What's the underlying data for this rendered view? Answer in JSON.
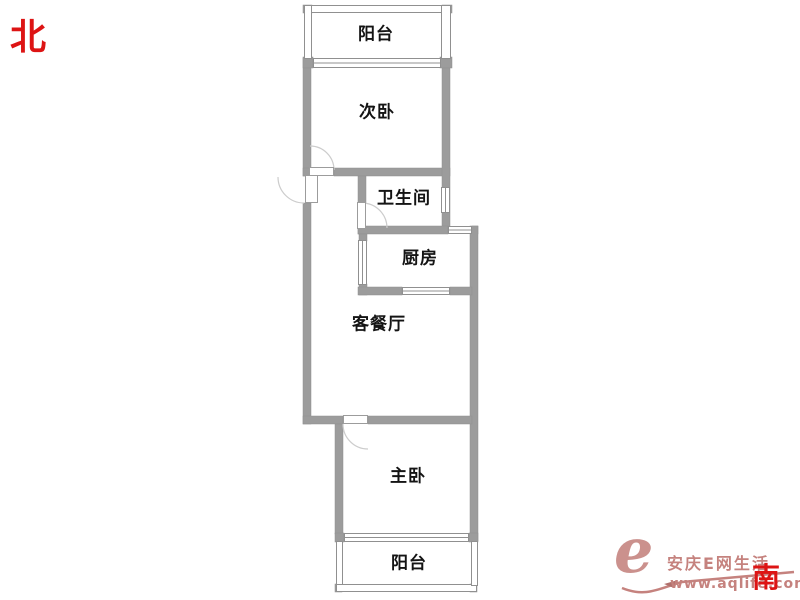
{
  "compass": {
    "north": "北",
    "south": "南"
  },
  "rooms": {
    "balcony_top": "阳台",
    "secondary_bedroom": "次卧",
    "bathroom": "卫生间",
    "kitchen": "厨房",
    "living_dining": "客餐厅",
    "master_bedroom": "主卧",
    "balcony_bottom": "阳台"
  },
  "watermark": {
    "logo_letter": "e",
    "site_name": "安庆E网生活",
    "url": "www.aqlife.com"
  },
  "colors": {
    "wall_gray": "#9c9c9c",
    "compass_red": "#dd1414",
    "watermark_rose": "#c5827e"
  }
}
